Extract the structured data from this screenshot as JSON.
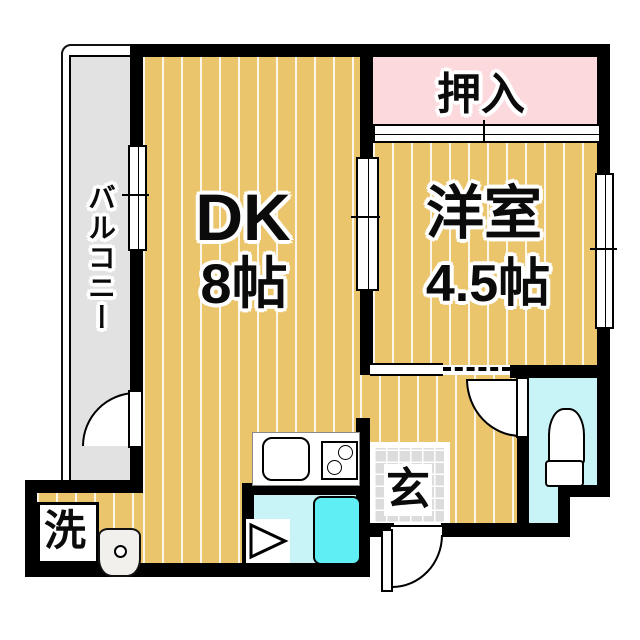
{
  "plan_title": "1DK apartment floor plan",
  "colors": {
    "wall": "#000000",
    "floor-tan": "#eac56c",
    "closet-pink": "#fcd9dd",
    "balcony-gray": "#e2e2e2",
    "tile-gray": "#dcdcdc",
    "wet-cyan": "#c8f3f7",
    "tub-cyan": "#5feef4"
  },
  "rooms": {
    "dk": {
      "label": "DK",
      "size": "8帖"
    },
    "western_room": {
      "label": "洋室",
      "size": "4.5帖"
    },
    "closet": {
      "label": "押入"
    },
    "balcony": {
      "label": "バルコニー"
    },
    "entrance": {
      "label": "玄"
    },
    "laundry": {
      "label": "洗"
    }
  },
  "fixtures": {
    "kitchen_sink": "kitchen-sink",
    "stove": "two-burner-stove",
    "bathtub": "bathtub",
    "toilet": "toilet",
    "wash_basin": "wash-basin",
    "bath_door": "folding-door-triangle"
  }
}
